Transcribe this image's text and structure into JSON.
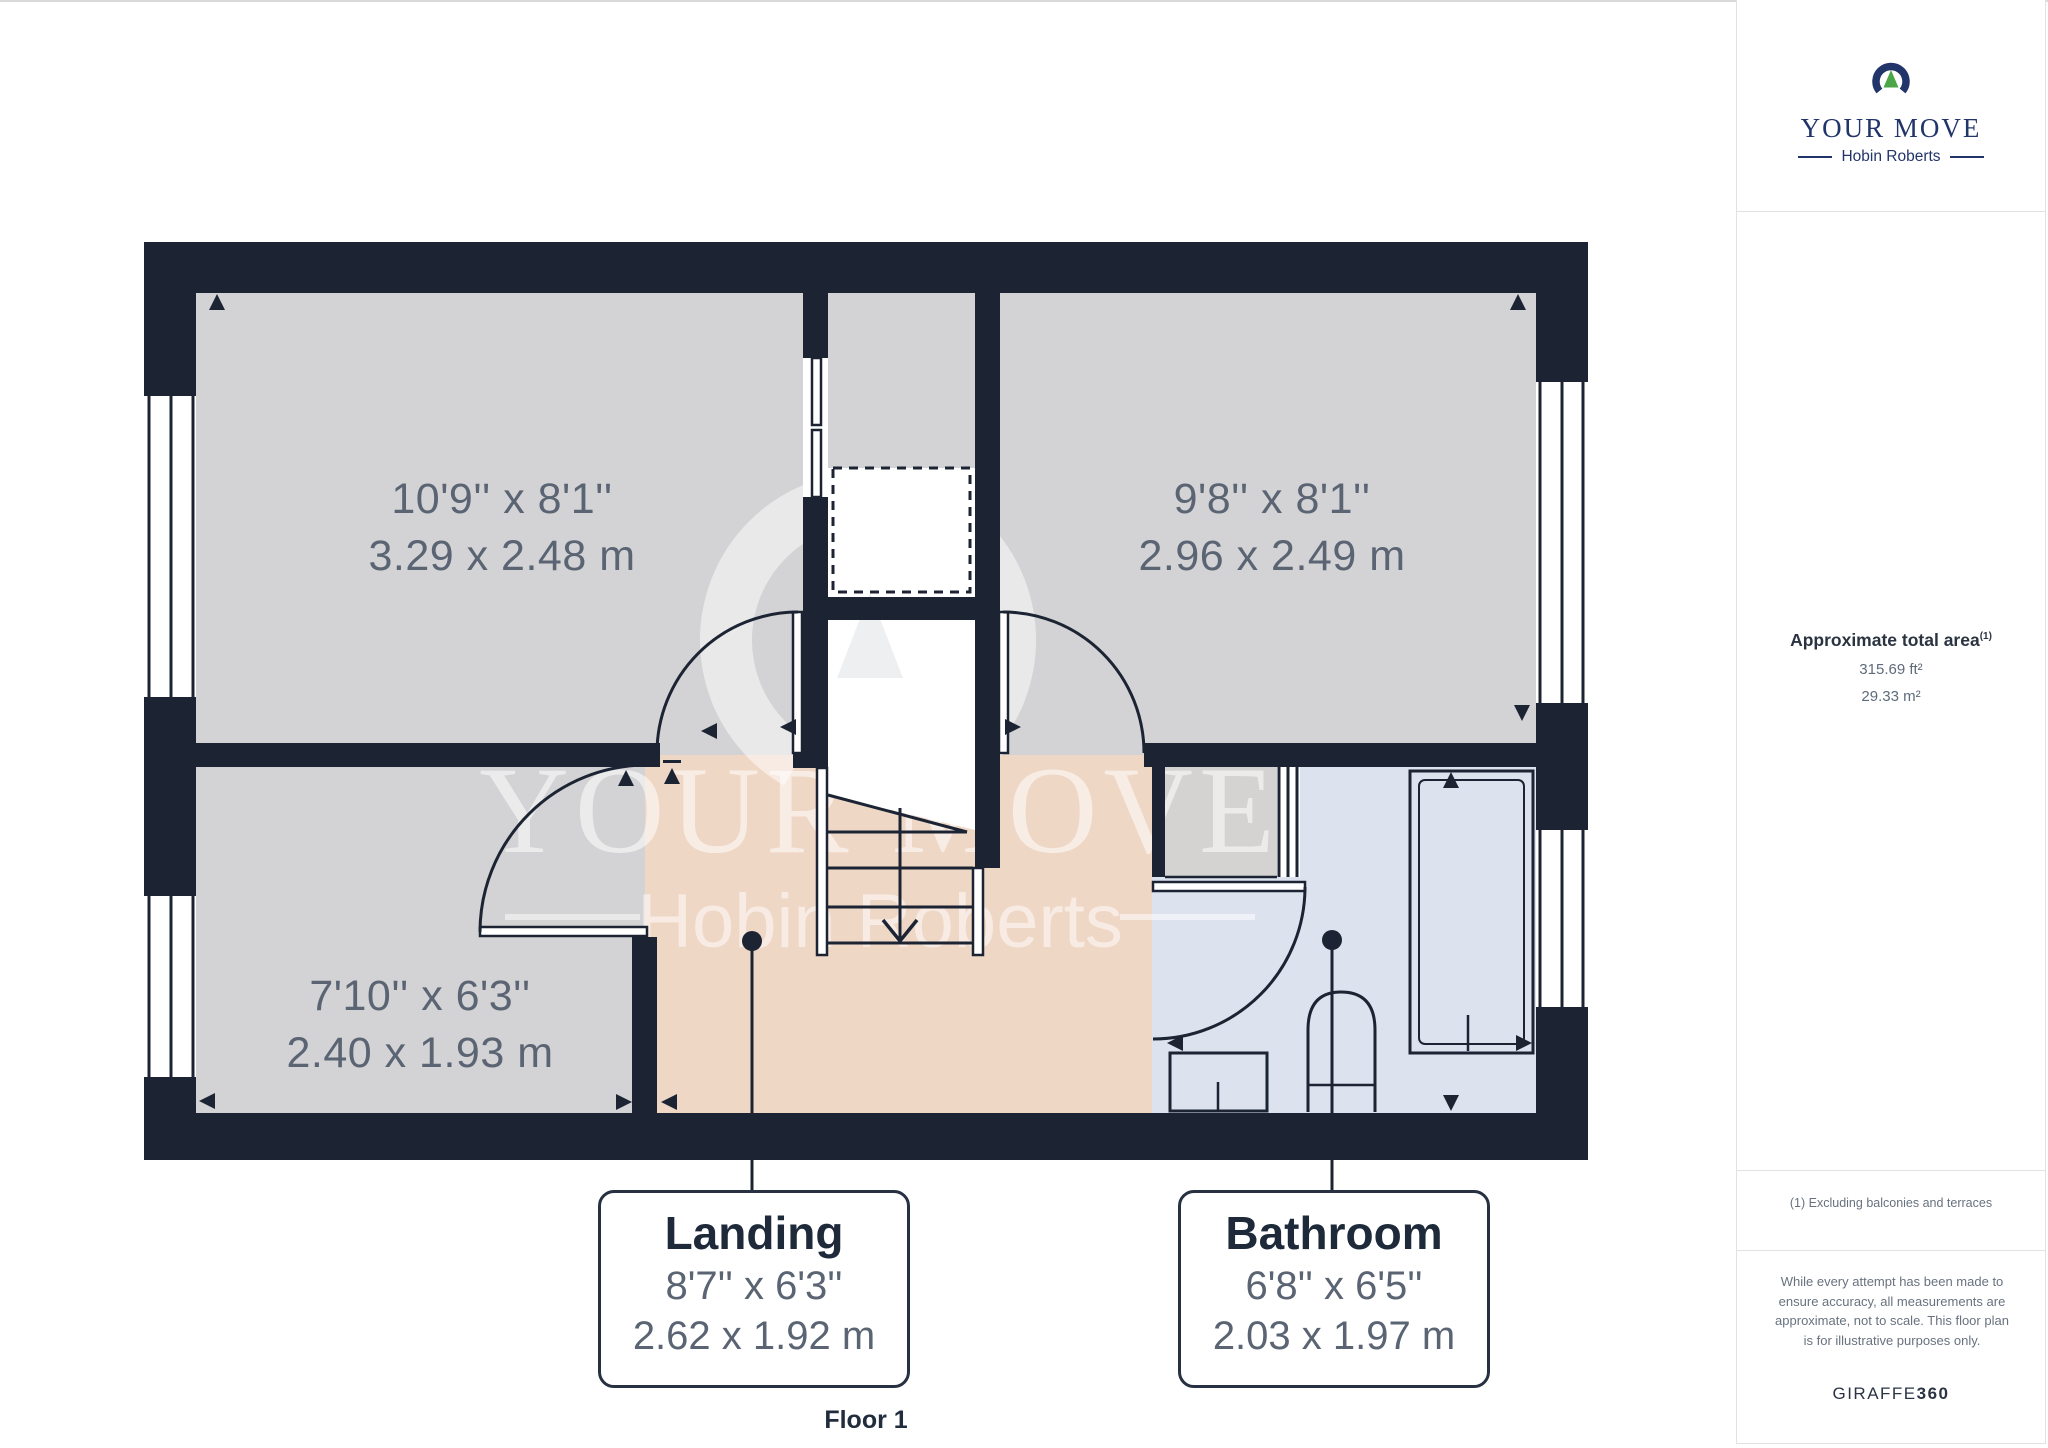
{
  "watermark": {
    "line1": "YOUR MOVE",
    "line2": "Hobin Roberts"
  },
  "rooms": [
    {
      "id": "bedroom-1",
      "imperial": "10'9'' x 8'1''",
      "metric": "3.29 x 2.48 m"
    },
    {
      "id": "bedroom-2",
      "imperial": "9'8'' x 8'1''",
      "metric": "2.96 x 2.49 m"
    },
    {
      "id": "bedroom-3",
      "imperial": "7'10'' x 6'3''",
      "metric": "2.40 x 1.93 m"
    }
  ],
  "callouts": [
    {
      "name": "Landing",
      "imperial": "8'7'' x 6'3''",
      "metric": "2.62 x 1.92 m"
    },
    {
      "name": "Bathroom",
      "imperial": "6'8'' x 6'5''",
      "metric": "2.03 x 1.97 m"
    }
  ],
  "floor_label": "Floor 1",
  "sidebar": {
    "brand": {
      "name": "YOUR MOVE",
      "subname": "Hobin Roberts"
    },
    "area": {
      "title": "Approximate total area",
      "sup": "(1)",
      "imperial": "315.69 ft²",
      "metric": "29.33 m²"
    },
    "footnote": "(1) Excluding balconies and terraces",
    "disclaimer": "While every attempt has been made to ensure accuracy, all measurements are approximate, not to scale. This floor plan is for illustrative purposes only.",
    "brand_footer": {
      "giraffe": "GIRAFFE",
      "n360": "360"
    }
  },
  "colors": {
    "wall": "#1c2433",
    "room_fill": "#d3d3d5",
    "landing_fill": "#efd7c6",
    "bathroom_fill": "#dce2ee",
    "cupboard_fill": "#d5d3d1",
    "brand_navy": "#22356b",
    "brand_green": "#4aa647",
    "label_gray": "#5a6473",
    "title_ink": "#1e2a3a"
  }
}
